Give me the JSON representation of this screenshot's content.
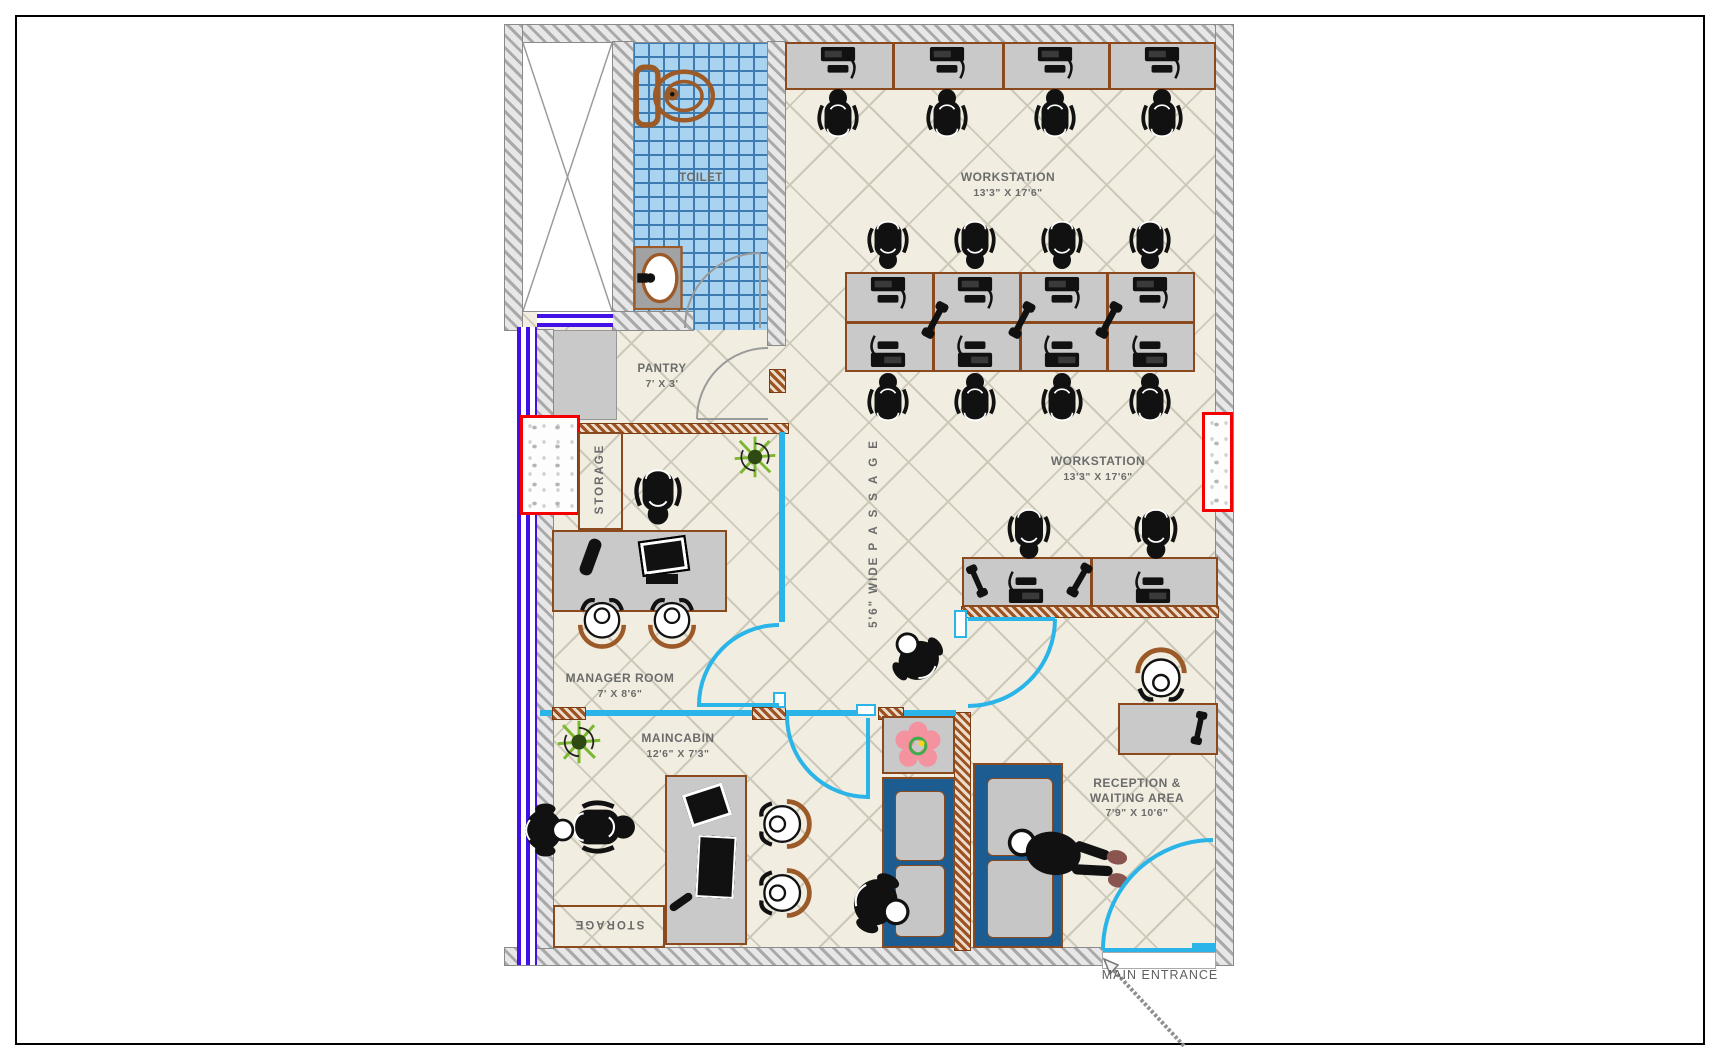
{
  "sheet": {
    "type": "office floor plan drawing"
  },
  "rooms": {
    "toilet": {
      "label": "TOILET"
    },
    "workstation_upper": {
      "label": "WORKSTATION",
      "dims": "13'3\" X 17'6\""
    },
    "workstation_lower": {
      "label": "WORKSTATION",
      "dims": "13'3\" X 17'6\""
    },
    "pantry": {
      "label": "PANTRY",
      "dims": "7' X 3'"
    },
    "storage_upper": {
      "label": "STORAGE"
    },
    "storage_lower": {
      "label": "STORAGE"
    },
    "manager_room": {
      "label": "MANAGER ROOM",
      "dims": "7' X 8'6\""
    },
    "maincabin": {
      "label": "MAINCABIN",
      "dims": "12'6\" X 7'3\""
    },
    "reception": {
      "label_line1": "RECEPTION &",
      "label_line2": "WAITING AREA",
      "dims": "7'9\" X 10'6\""
    },
    "passage": {
      "label_prefix": "5'6\" WIDE ",
      "label_word": "PASSAGE"
    },
    "main_entrance": {
      "label": "MAIN ENTRANCE"
    }
  },
  "colors": {
    "floor": "#f1eee1",
    "floor_grid": "#ccc9ba",
    "wall_gray": "#a9a9a9",
    "wall_brown": "#9c5222",
    "partition_cyan": "#2ab4e8",
    "tile_blue": "#a9d3ee",
    "tile_line": "#3d7cb2",
    "window_purple": "#4410e8",
    "slab_red": "#f40000",
    "desk_gray": "#c9c9c9",
    "furniture_trim_brown": "#8a4a1e",
    "sofa_blue": "#1d5c90",
    "label_gray": "#6b6b6b",
    "plant_green": "#7cb82f",
    "flower_pink": "#f492a0"
  },
  "icons": {
    "pc": "pc-icon",
    "office_chair": "office-chair-icon",
    "guest_chair": "guest-chair-icon",
    "phone": "phone-icon",
    "plant": "plant-icon",
    "toilet_fixture": "toilet-icon",
    "basin": "basin-icon",
    "flower": "flower-icon",
    "person": "person-icon",
    "lounging_person": "lounging-person-icon",
    "door_arc": "door-arc",
    "lift_shaft": "lift-shaft-x"
  }
}
